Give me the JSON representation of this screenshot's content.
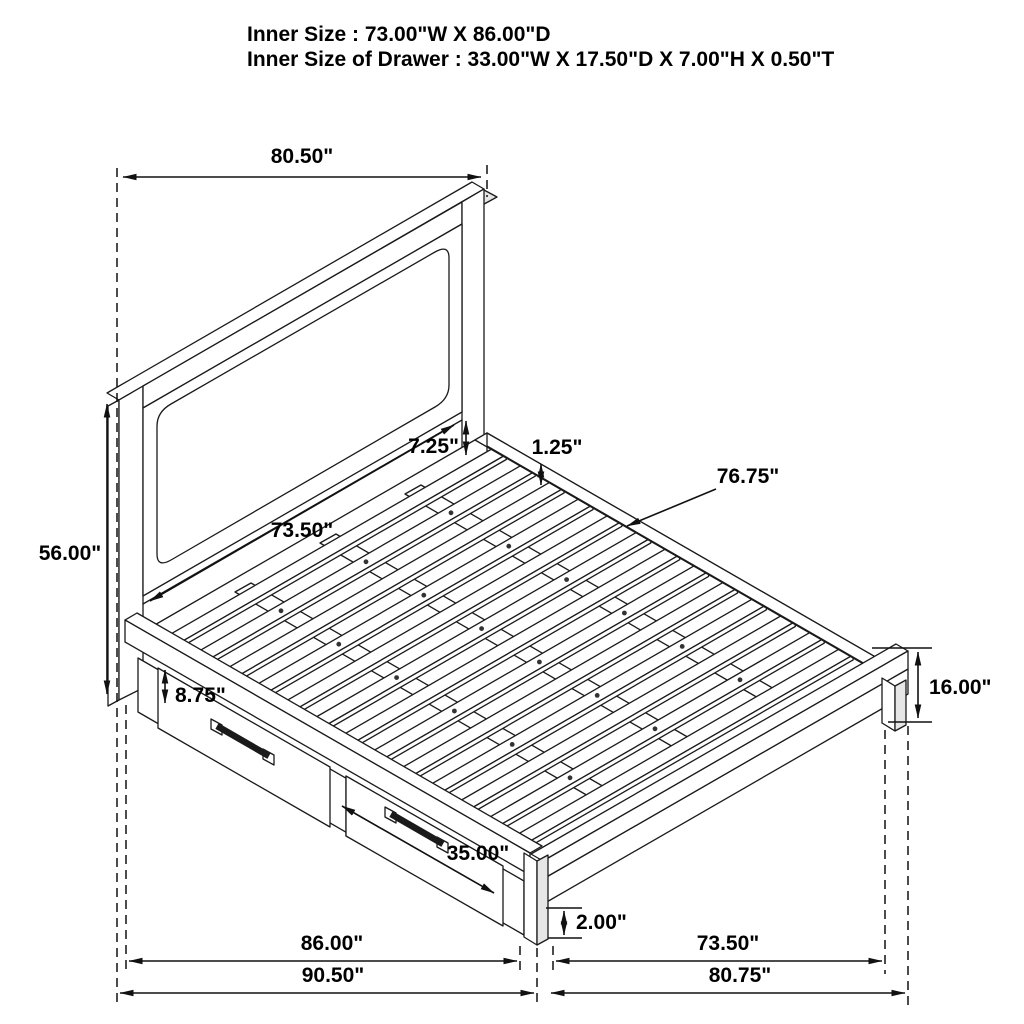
{
  "title_block": {
    "line1": "Inner Size : 73.00\"W X 86.00\"D",
    "line2": "Inner Size of Drawer : 33.00\"W X 17.50\"D X 7.00\"H X 0.50\"T"
  },
  "dimensions": {
    "headboard_width": "80.50\"",
    "headboard_height": "56.00\"",
    "headboard_inner_width": "73.50\"",
    "panel_to_deck_gap": "7.25\"",
    "slat_thickness": "1.25\"",
    "slat_deck_length": "76.75\"",
    "drawer_front_height": "8.75\"",
    "drawer_front_width": "35.00\"",
    "foot_clearance": "2.00\"",
    "footboard_height": "16.00\"",
    "storage_base_length": "86.00\"",
    "overall_length": "90.50\"",
    "footboard_inner_width": "73.50\"",
    "overall_width": "80.75\""
  },
  "colors": {
    "line": "#1a1a1a",
    "background": "#ffffff",
    "shading": "#e6e6e6"
  }
}
